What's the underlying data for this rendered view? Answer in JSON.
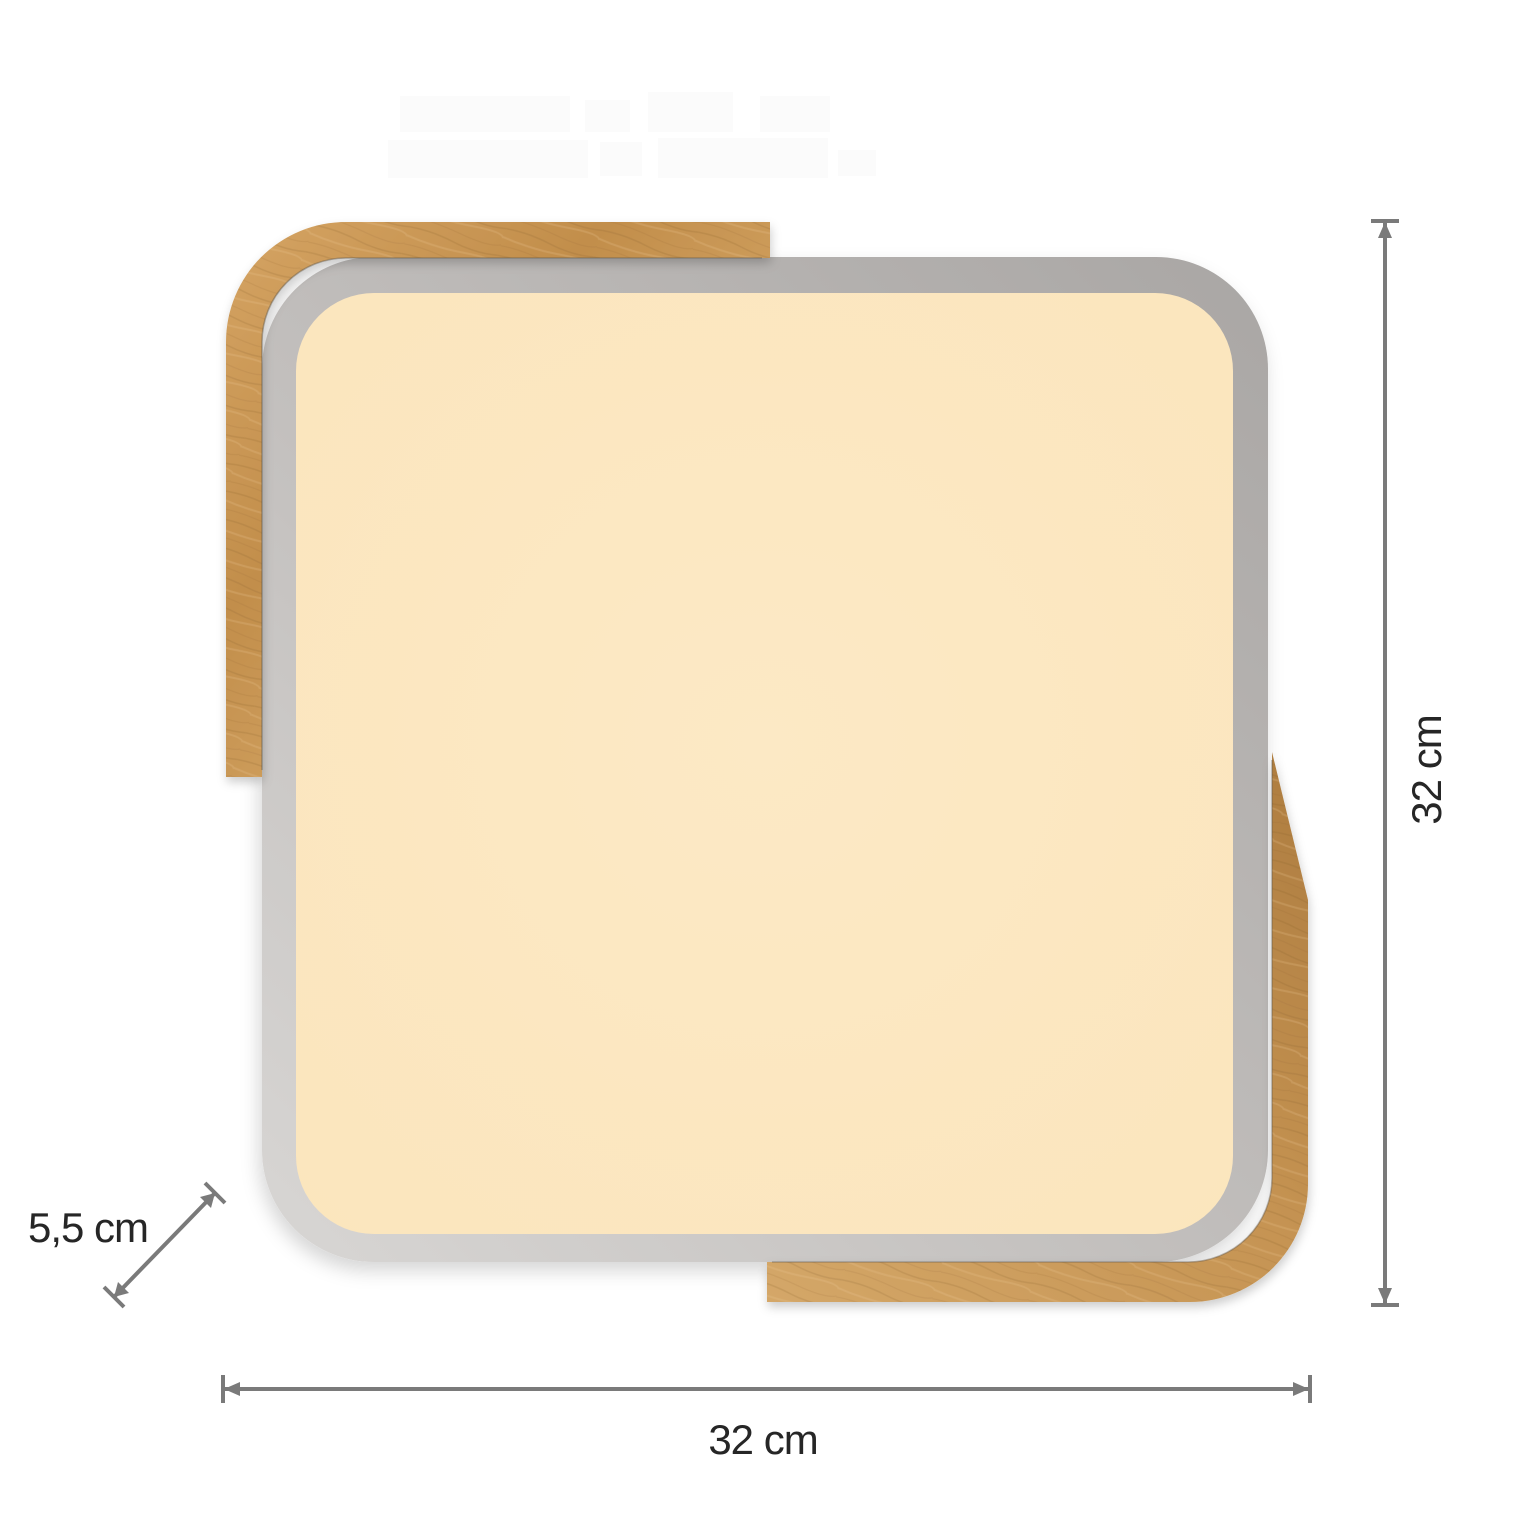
{
  "diagram": {
    "labels": {
      "height": "32 cm",
      "width": "32 cm",
      "depth": "5,5 cm"
    },
    "colors": {
      "wood_accent": "#c59352",
      "frame_rim": "#b5b2b0",
      "light_panel_glow": "#fbe7c1",
      "dimension_line": "#7a7a7a",
      "label_text": "#262626",
      "background": "#ffffff"
    }
  }
}
